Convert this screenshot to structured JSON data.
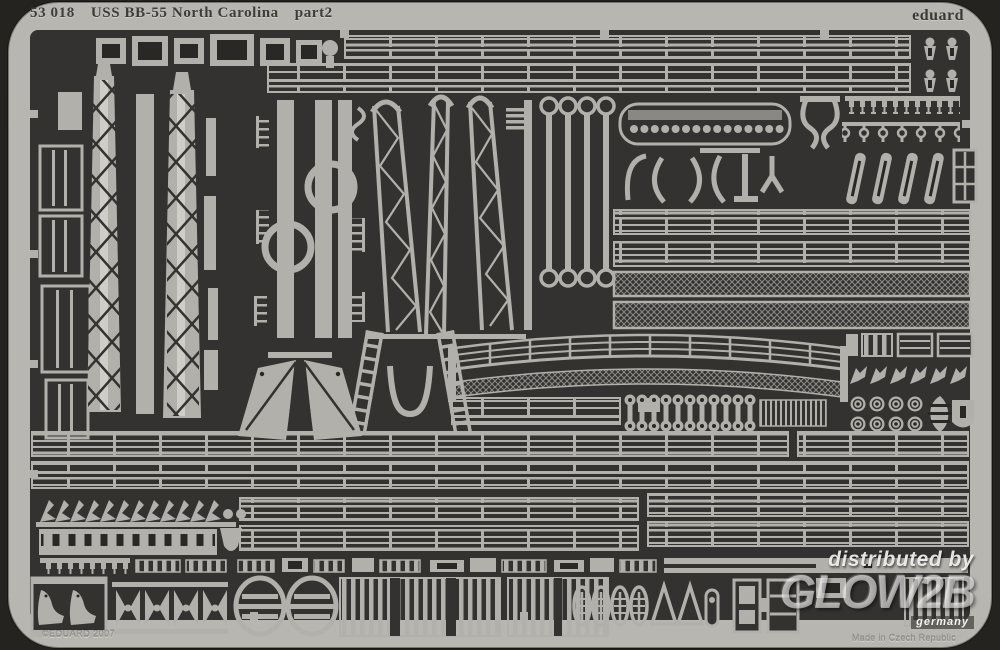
{
  "page": {
    "description": "Product photograph of a photo-etched metal detail fret for a ship model kit"
  },
  "header": {
    "catalog_number": "53 018",
    "title": "USS BB-55 North Carolina",
    "part_label": "part2",
    "brand": "eduard"
  },
  "footer": {
    "copyright": "©EDUARD 2007",
    "origin": "Made in Czech Republic"
  },
  "watermark": {
    "line1": "distributed by",
    "logo": "GLOW2B",
    "country": "germany"
  },
  "colors": {
    "bg": "#242320",
    "frame": "#b8b6b0",
    "frame-shadow": "#8f8d87",
    "dark": "#343231",
    "dark2": "#292826",
    "metal": "#b2b0aa",
    "metal-bright": "#cfcdc7",
    "metal-dim": "#8a8883",
    "ink": "#3e3c38",
    "emboss": "#9b9993",
    "wm": "#ffffff"
  }
}
